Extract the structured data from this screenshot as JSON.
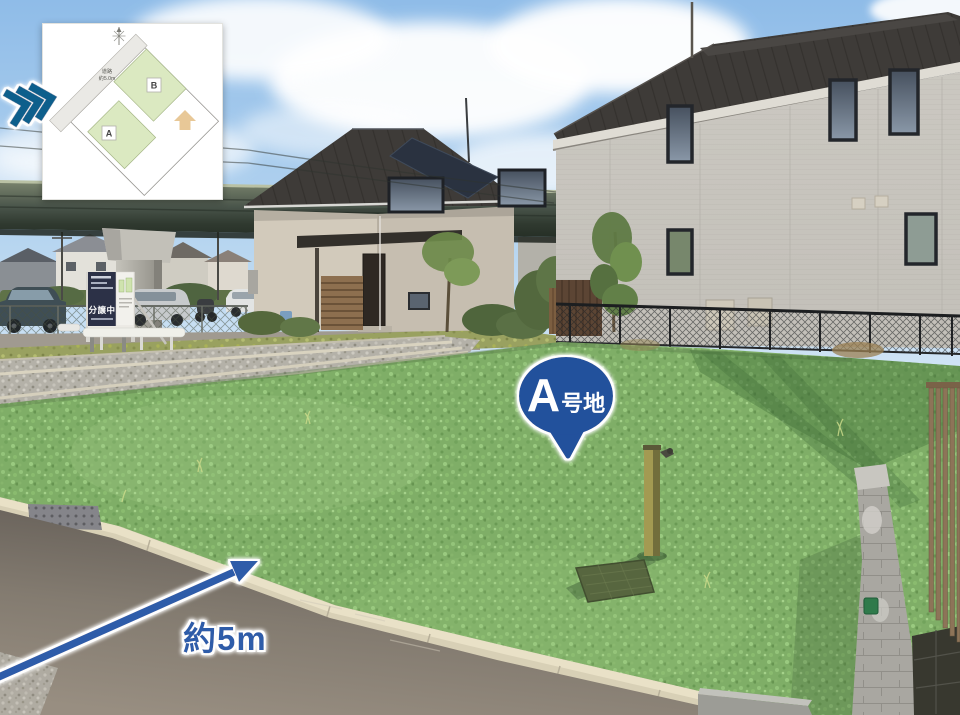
{
  "inset_map": {
    "lot_a_label": "A",
    "lot_b_label": "B",
    "road_label_line1": "道路",
    "road_label_line2": "約5.0m",
    "lot_fill_color": "#dbe9c1",
    "house_icon_color": "#e8c897"
  },
  "overlays": {
    "plot_badge": {
      "letter": "A",
      "suffix": "号地",
      "color": "#24519c"
    },
    "dimension_arrow": {
      "label": "約5m",
      "color": "#2e5ca9"
    },
    "direction_chevrons": {
      "color": "#0f5e8c"
    }
  },
  "signboard": {
    "main_text": "分譲中"
  },
  "colors": {
    "lot_overlay_green": "#7fae67",
    "sky_blue": "#8fbce8"
  }
}
